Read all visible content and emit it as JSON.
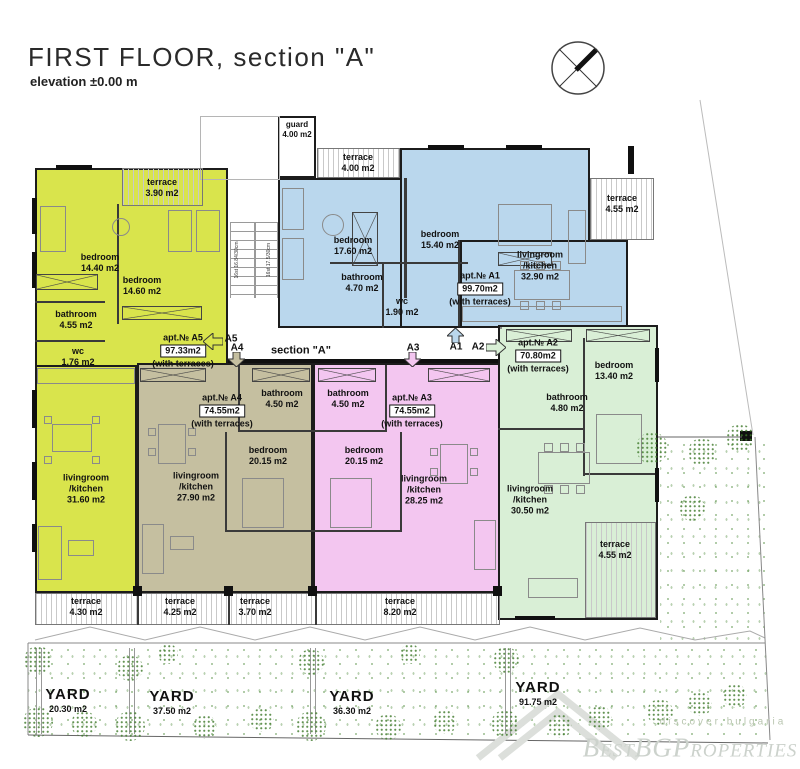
{
  "header": {
    "title": "FIRST FLOOR, section \"A\"",
    "subtitle": "elevation ±0.00 m"
  },
  "corridor": {
    "section_label": "section \"A\"",
    "arrows": [
      {
        "id": "A5"
      },
      {
        "id": "A4"
      },
      {
        "id": "A3"
      },
      {
        "id": "A1"
      },
      {
        "id": "A2"
      }
    ]
  },
  "guard_room": {
    "name": "guard",
    "area": "4.00 m2"
  },
  "stairs": {
    "spec_left": "16st 16.84/30cm",
    "spec_right": "16st 17.5/30cm"
  },
  "apartments": [
    {
      "id": "A5",
      "apt_label": "apt.№ A5",
      "total_area": "97.33m2",
      "terrace_note": "(with terraces)",
      "fill": "#d9e44c",
      "rooms": [
        {
          "name": "bedroom",
          "area": "14.40 m2"
        },
        {
          "name": "bedroom",
          "area": "14.60 m2"
        },
        {
          "name": "bathroom",
          "area": "4.55 m2"
        },
        {
          "name": "wc",
          "area": "1.76 m2"
        },
        {
          "name": "livingroom",
          "name2": "/kitchen",
          "area": "31.60 m2"
        }
      ],
      "terraces": [
        {
          "name": "terrace",
          "area": "3.90 m2"
        }
      ]
    },
    {
      "id": "A1",
      "apt_label": "apt.№ A1",
      "total_area": "99.70m2",
      "terrace_note": "(with terraces)",
      "fill": "#bad7ed",
      "rooms": [
        {
          "name": "bedroom",
          "area": "17.60 m2"
        },
        {
          "name": "bedroom",
          "area": "15.40 m2"
        },
        {
          "name": "bathroom",
          "area": "4.70 m2"
        },
        {
          "name": "wc",
          "area": "1.90 m2"
        },
        {
          "name": "livingroom",
          "name2": "/kitchen",
          "area": "32.90 m2"
        }
      ],
      "terraces": [
        {
          "name": "terrace",
          "area": "4.00 m2"
        },
        {
          "name": "terrace",
          "area": "4.55 m2"
        }
      ]
    },
    {
      "id": "A4",
      "apt_label": "apt.№ A4",
      "total_area": "74.55m2",
      "terrace_note": "(with terraces)",
      "fill": "#c5bfa0",
      "rooms": [
        {
          "name": "bathroom",
          "area": "4.50 m2"
        },
        {
          "name": "bedroom",
          "area": "20.15 m2"
        },
        {
          "name": "livingroom",
          "name2": "/kitchen",
          "area": "27.90 m2"
        }
      ],
      "terraces": []
    },
    {
      "id": "A3",
      "apt_label": "apt.№ A3",
      "total_area": "74.55m2",
      "terrace_note": "(with terraces)",
      "fill": "#f3c6f0",
      "rooms": [
        {
          "name": "bathroom",
          "area": "4.50 m2"
        },
        {
          "name": "bedroom",
          "area": "20.15 m2"
        },
        {
          "name": "livingroom",
          "name2": "/kitchen",
          "area": "28.25 m2"
        }
      ],
      "terraces": []
    },
    {
      "id": "A2",
      "apt_label": "apt.№ A2",
      "total_area": "70.80m2",
      "terrace_note": "(with terraces)",
      "fill": "#d9efd6",
      "rooms": [
        {
          "name": "bedroom",
          "area": "13.40 m2"
        },
        {
          "name": "bathroom",
          "area": "4.80 m2"
        },
        {
          "name": "livingroom",
          "name2": "/kitchen",
          "area": "30.50 m2"
        }
      ],
      "terraces": [
        {
          "name": "terrace",
          "area": "4.55 m2"
        }
      ]
    }
  ],
  "terrace_strip": [
    {
      "name": "terrace",
      "area": "4.30 m2"
    },
    {
      "name": "terrace",
      "area": "4.25 m2"
    },
    {
      "name": "terrace",
      "area": "3.70 m2"
    },
    {
      "name": "terrace",
      "area": "8.20 m2"
    }
  ],
  "yards": [
    {
      "name": "YARD",
      "area": "20.30 m2"
    },
    {
      "name": "YARD",
      "area": "37.50 m2"
    },
    {
      "name": "YARD",
      "area": "36.30 m2"
    },
    {
      "name": "YARD",
      "area": "91.75 m2"
    }
  ],
  "watermark": {
    "tagline": "discover bulgaria",
    "brand": "BestBGProperties"
  },
  "colors": {
    "a5": "#d9e44c",
    "a1": "#bad7ed",
    "a4": "#c5bfa0",
    "a3": "#f3c6f0",
    "a2": "#d9efd6",
    "wall": "#1c1c1c",
    "yard_green": "#5f9c4a"
  }
}
